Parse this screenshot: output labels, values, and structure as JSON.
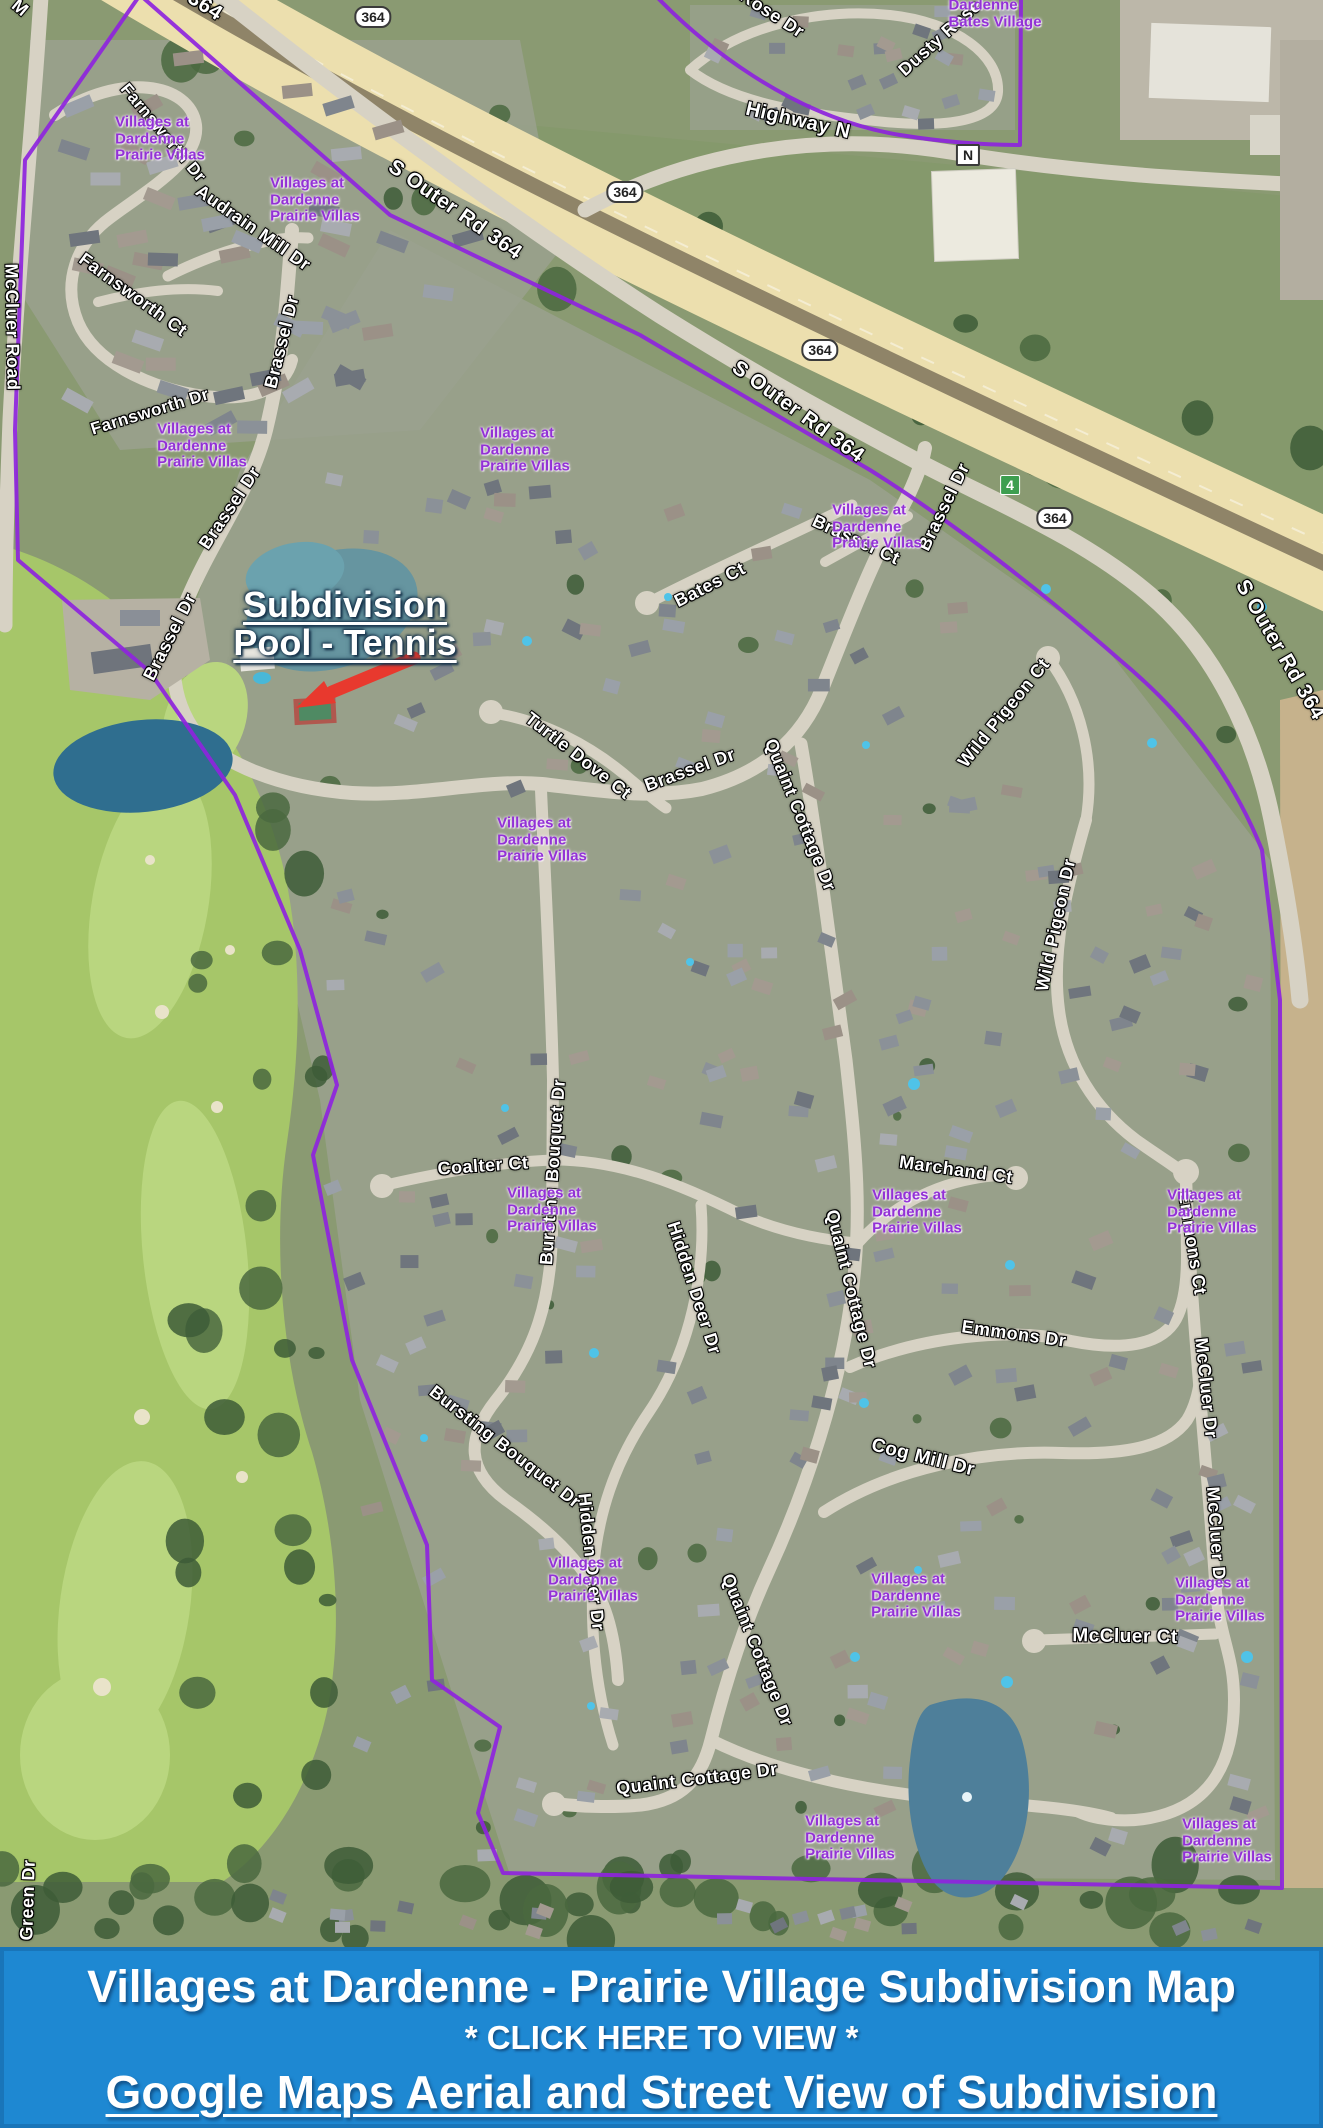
{
  "map": {
    "pool_annotation": {
      "line1": "Subdivision",
      "line2": "Pool - Tennis"
    },
    "villa_label_text": [
      "Villages at",
      "Dardenne",
      "Prairie Villas"
    ],
    "villa_label_positions": [
      [
        160,
        139
      ],
      [
        315,
        200
      ],
      [
        202,
        446
      ],
      [
        525,
        450
      ],
      [
        877,
        527
      ],
      [
        542,
        840
      ],
      [
        552,
        1210
      ],
      [
        917,
        1212
      ],
      [
        1212,
        1212
      ],
      [
        593,
        1580
      ],
      [
        916,
        1596
      ],
      [
        1220,
        1600
      ],
      [
        850,
        1838
      ],
      [
        1227,
        1841
      ]
    ],
    "bates_village_label": {
      "lines": [
        "Dardenne",
        "Bates Village"
      ],
      "x": 995,
      "y": 14
    },
    "street_labels": [
      {
        "text": "S Outer Rd 364",
        "x": 455,
        "y": 210,
        "rot": 35,
        "size": 21
      },
      {
        "text": "S Outer Rd 364",
        "x": 798,
        "y": 412,
        "rot": 36,
        "size": 21
      },
      {
        "text": "S Outer Rd 364",
        "x": 1280,
        "y": 650,
        "rot": 60,
        "size": 21
      },
      {
        "text": "364",
        "x": 205,
        "y": 6,
        "rot": 33,
        "size": 21
      },
      {
        "text": "Highway N",
        "x": 798,
        "y": 121,
        "rot": 13,
        "size": 20
      },
      {
        "text": "Rose Dr",
        "x": 772,
        "y": 14,
        "rot": 33,
        "size": 18
      },
      {
        "text": "Dusty Rose",
        "x": 940,
        "y": 38,
        "rot": -42,
        "size": 18
      },
      {
        "text": "M",
        "x": 20,
        "y": 8,
        "rot": 40,
        "size": 18
      },
      {
        "text": "McCluer Road",
        "x": 12,
        "y": 327,
        "rot": 89,
        "size": 18
      },
      {
        "text": "Farnsworth Dr",
        "x": 163,
        "y": 133,
        "rot": 50,
        "size": 17
      },
      {
        "text": "Audrain Mill Dr",
        "x": 253,
        "y": 228,
        "rot": 35,
        "size": 18
      },
      {
        "text": "Farnsworth Ct",
        "x": 133,
        "y": 295,
        "rot": 36,
        "size": 18
      },
      {
        "text": "Farnsworth Dr",
        "x": 150,
        "y": 412,
        "rot": -17,
        "size": 17
      },
      {
        "text": "Brassel Dr",
        "x": 282,
        "y": 342,
        "rot": -76,
        "size": 18
      },
      {
        "text": "Brassel Dr",
        "x": 230,
        "y": 508,
        "rot": -56,
        "size": 18
      },
      {
        "text": "Brassel Dr",
        "x": 170,
        "y": 637,
        "rot": -63,
        "size": 18
      },
      {
        "text": "Brassel Dr",
        "x": 690,
        "y": 770,
        "rot": -20,
        "size": 18
      },
      {
        "text": "Brassel Dr",
        "x": 944,
        "y": 507,
        "rot": -64,
        "size": 18
      },
      {
        "text": "Brassel Ct",
        "x": 856,
        "y": 540,
        "rot": 25,
        "size": 18
      },
      {
        "text": "Bates Ct",
        "x": 710,
        "y": 585,
        "rot": -27,
        "size": 18
      },
      {
        "text": "Turtle Dove Ct",
        "x": 578,
        "y": 756,
        "rot": 38,
        "size": 18
      },
      {
        "text": "Bursting Bouquet Dr",
        "x": 553,
        "y": 1172,
        "rot": -86,
        "size": 18
      },
      {
        "text": "Bursting Bouquet Dr",
        "x": 505,
        "y": 1447,
        "rot": 38,
        "size": 18
      },
      {
        "text": "Coalter Ct",
        "x": 483,
        "y": 1166,
        "rot": -4,
        "size": 18
      },
      {
        "text": "Hidden Deer Dr",
        "x": 694,
        "y": 1288,
        "rot": 72,
        "size": 18
      },
      {
        "text": "Hidden Deer Dr",
        "x": 591,
        "y": 1562,
        "rot": 84,
        "size": 18
      },
      {
        "text": "Quaint Cottage Dr",
        "x": 800,
        "y": 815,
        "rot": 68,
        "size": 18
      },
      {
        "text": "Quaint Cottage Dr",
        "x": 851,
        "y": 1289,
        "rot": 76,
        "size": 18
      },
      {
        "text": "Quaint Cottage Dr",
        "x": 757,
        "y": 1650,
        "rot": 68,
        "size": 18
      },
      {
        "text": "Quaint Cottage Dr",
        "x": 697,
        "y": 1779,
        "rot": -7,
        "size": 18
      },
      {
        "text": "Marchand Ct",
        "x": 956,
        "y": 1170,
        "rot": 8,
        "size": 18
      },
      {
        "text": "Emmons Dr",
        "x": 1014,
        "y": 1334,
        "rot": 8,
        "size": 18
      },
      {
        "text": "Emmons Ct",
        "x": 1192,
        "y": 1243,
        "rot": 81,
        "size": 18
      },
      {
        "text": "Wild Pigeon Ct",
        "x": 1004,
        "y": 713,
        "rot": -51,
        "size": 18
      },
      {
        "text": "Wild Pigeon Dr",
        "x": 1056,
        "y": 925,
        "rot": -78,
        "size": 18
      },
      {
        "text": "Cog Mill Dr",
        "x": 923,
        "y": 1458,
        "rot": 14,
        "size": 19
      },
      {
        "text": "McCluer Dr",
        "x": 1206,
        "y": 1388,
        "rot": 84,
        "size": 18
      },
      {
        "text": "McCluer Dr",
        "x": 1216,
        "y": 1537,
        "rot": 86,
        "size": 18
      },
      {
        "text": "McCluer Ct",
        "x": 1125,
        "y": 1637,
        "rot": 1,
        "size": 19
      },
      {
        "text": "Green Dr",
        "x": 28,
        "y": 1900,
        "rot": -88,
        "size": 18
      }
    ],
    "route_shields": [
      {
        "label": "364",
        "x": 373,
        "y": 17
      },
      {
        "label": "364",
        "x": 625,
        "y": 192
      },
      {
        "label": "364",
        "x": 820,
        "y": 350
      },
      {
        "label": "364",
        "x": 1055,
        "y": 518
      },
      {
        "label": "N",
        "x": 968,
        "y": 155
      },
      {
        "label": "4",
        "x": 1010,
        "y": 485
      }
    ],
    "colors": {
      "boundary": "#8e24dd",
      "villa_text": "#9331d6",
      "arrow": "#e8392e",
      "highway": "#ecdfae",
      "road": "#d7d2c4",
      "golf": "#a6c669",
      "water": "#4e7f9a"
    }
  },
  "footer": {
    "title": "Villages at Dardenne - Prairie Village Subdivision Map",
    "cta": "* CLICK HERE TO VIEW *",
    "link": "Google Maps Aerial and Street View of Subdivision",
    "bg": "#1e88d2"
  }
}
